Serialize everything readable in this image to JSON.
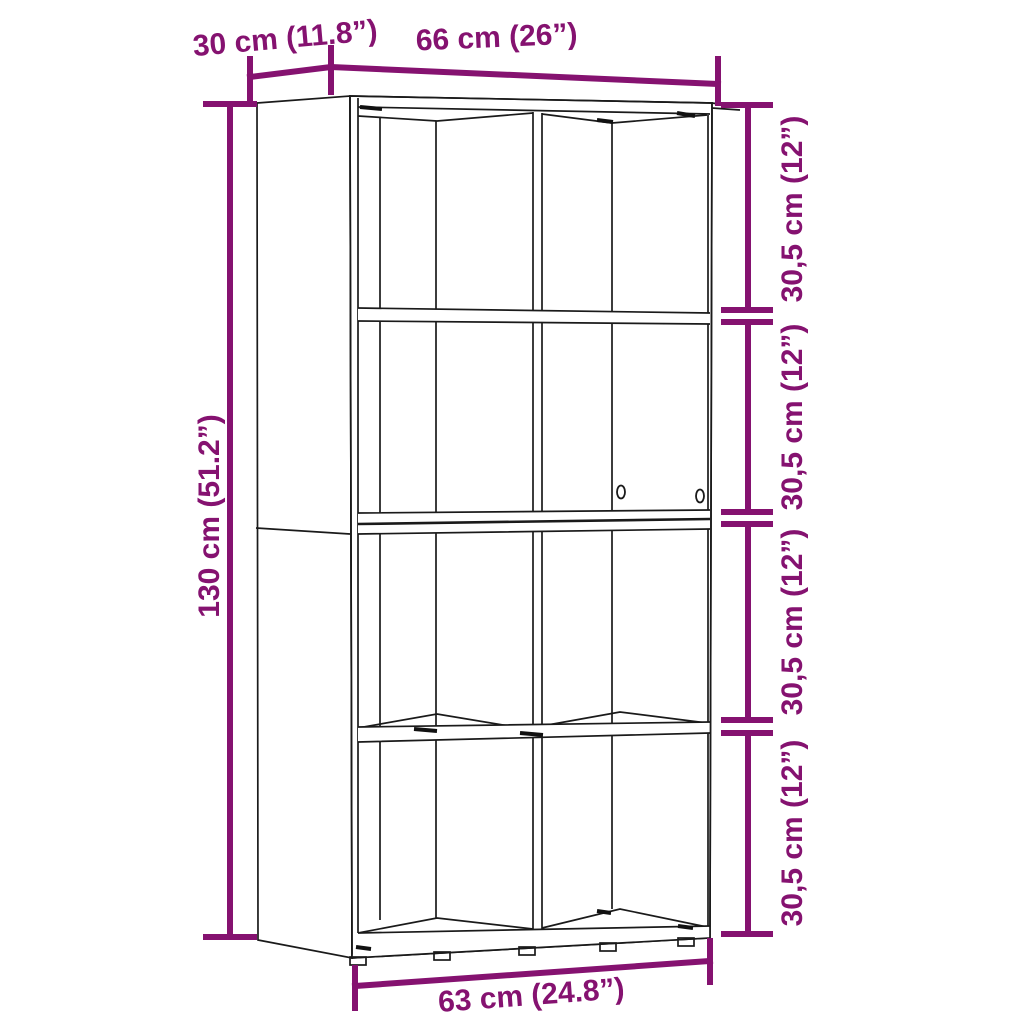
{
  "canvas": {
    "width": 1024,
    "height": 1024,
    "background": "#ffffff"
  },
  "diagram": {
    "kind": "furniture-dimension-drawing",
    "subject": "book cabinet with 8 open compartments (2 columns x 4 rows)",
    "colors": {
      "dimension_accent": "#851270",
      "drawing_outline": "#1a1a1a"
    },
    "dimensions": {
      "depth": {
        "label": "30 cm (11.8”)"
      },
      "width": {
        "label": "66 cm (26”)"
      },
      "height": {
        "label": "130 cm (51.2”)"
      },
      "inner_width": {
        "label": "63 cm (24.8”)"
      },
      "compartments": [
        {
          "label": "30,5 cm (12”)"
        },
        {
          "label": "30,5 cm (12”)"
        },
        {
          "label": "30,5 cm (12”)"
        },
        {
          "label": "30,5 cm (12”)"
        }
      ]
    }
  }
}
